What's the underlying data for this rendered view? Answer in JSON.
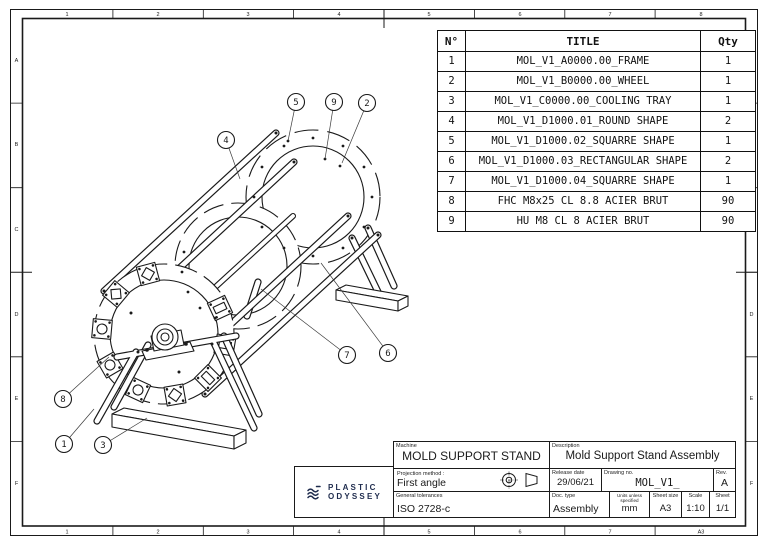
{
  "colors": {
    "ink": "#1a1a1a",
    "logo_navy": "#1e2b4d",
    "background": "#ffffff"
  },
  "frame": {
    "top_labels": [
      "1",
      "2",
      "3",
      "4",
      "5",
      "6",
      "7",
      "8"
    ],
    "bottom_labels": [
      "1",
      "2",
      "3",
      "4",
      "5",
      "6",
      "7",
      "A3"
    ],
    "side_labels": [
      "A",
      "B",
      "C",
      "D",
      "E",
      "F"
    ]
  },
  "bom": {
    "headers": {
      "no": "N°",
      "title": "TITLE",
      "qty": "Qty"
    },
    "rows": [
      {
        "no": "1",
        "title": "MOL_V1_A0000.00_FRAME",
        "qty": "1"
      },
      {
        "no": "2",
        "title": "MOL_V1_B0000.00_WHEEL",
        "qty": "1"
      },
      {
        "no": "3",
        "title": "MOL_V1_C0000.00_COOLING TRAY",
        "qty": "1"
      },
      {
        "no": "4",
        "title": "MOL_V1_D1000.01_ROUND SHAPE",
        "qty": "2"
      },
      {
        "no": "5",
        "title": "MOL_V1_D1000.02_SQUARRE SHAPE",
        "qty": "1"
      },
      {
        "no": "6",
        "title": "MOL_V1_D1000.03_RECTANGULAR SHAPE",
        "qty": "2"
      },
      {
        "no": "7",
        "title": "MOL_V1_D1000.04_SQUARRE SHAPE",
        "qty": "1"
      },
      {
        "no": "8",
        "title": "FHC M8x25 CL 8.8 ACIER BRUT",
        "qty": "90"
      },
      {
        "no": "9",
        "title": "HU M8 CL 8 ACIER BRUT",
        "qty": "90"
      }
    ]
  },
  "title_block": {
    "machine_label": "Machine",
    "machine": "MOLD SUPPORT STAND",
    "description_label": "Description",
    "description": "Mold Support Stand Assembly",
    "projection_label": "Projection method :",
    "projection": "First angle",
    "release_label": "Release date",
    "release_date": "29/06/21",
    "drawing_no_label": "Drawing no.",
    "drawing_no": "MOL_V1_",
    "rev_label": "Rev.",
    "rev": "A",
    "tolerances_label": "General tolerances",
    "tolerances": "ISO 2728-c",
    "doc_type_label": "Doc. type",
    "doc_type": "Assembly",
    "units_label": "Units unless\nspecified",
    "units": "mm",
    "sheet_size_label": "Sheet size",
    "sheet_size": "A3",
    "scale_label": "Scale",
    "scale": "1:10",
    "sheet_label": "Sheet",
    "sheet": "1/1"
  },
  "logo": {
    "line1": "PLASTIC",
    "line2": "ODYSSEY"
  },
  "drawing": {
    "balloons": [
      {
        "n": "1",
        "x": 64,
        "y": 444,
        "tx": 94,
        "ty": 409
      },
      {
        "n": "2",
        "x": 367,
        "y": 103,
        "tx": 342,
        "ty": 163
      },
      {
        "n": "3",
        "x": 103,
        "y": 445,
        "tx": 147,
        "ty": 418
      },
      {
        "n": "4",
        "x": 226,
        "y": 140,
        "tx": 240,
        "ty": 179
      },
      {
        "n": "5",
        "x": 296,
        "y": 102,
        "tx": 288,
        "ty": 141
      },
      {
        "n": "6",
        "x": 388,
        "y": 353,
        "tx": 321,
        "ty": 263
      },
      {
        "n": "7",
        "x": 347,
        "y": 355,
        "tx": 261,
        "ty": 289
      },
      {
        "n": "8",
        "x": 63,
        "y": 399,
        "tx": 109,
        "ty": 357
      },
      {
        "n": "9",
        "x": 334,
        "y": 102,
        "tx": 325,
        "ty": 159
      }
    ]
  }
}
